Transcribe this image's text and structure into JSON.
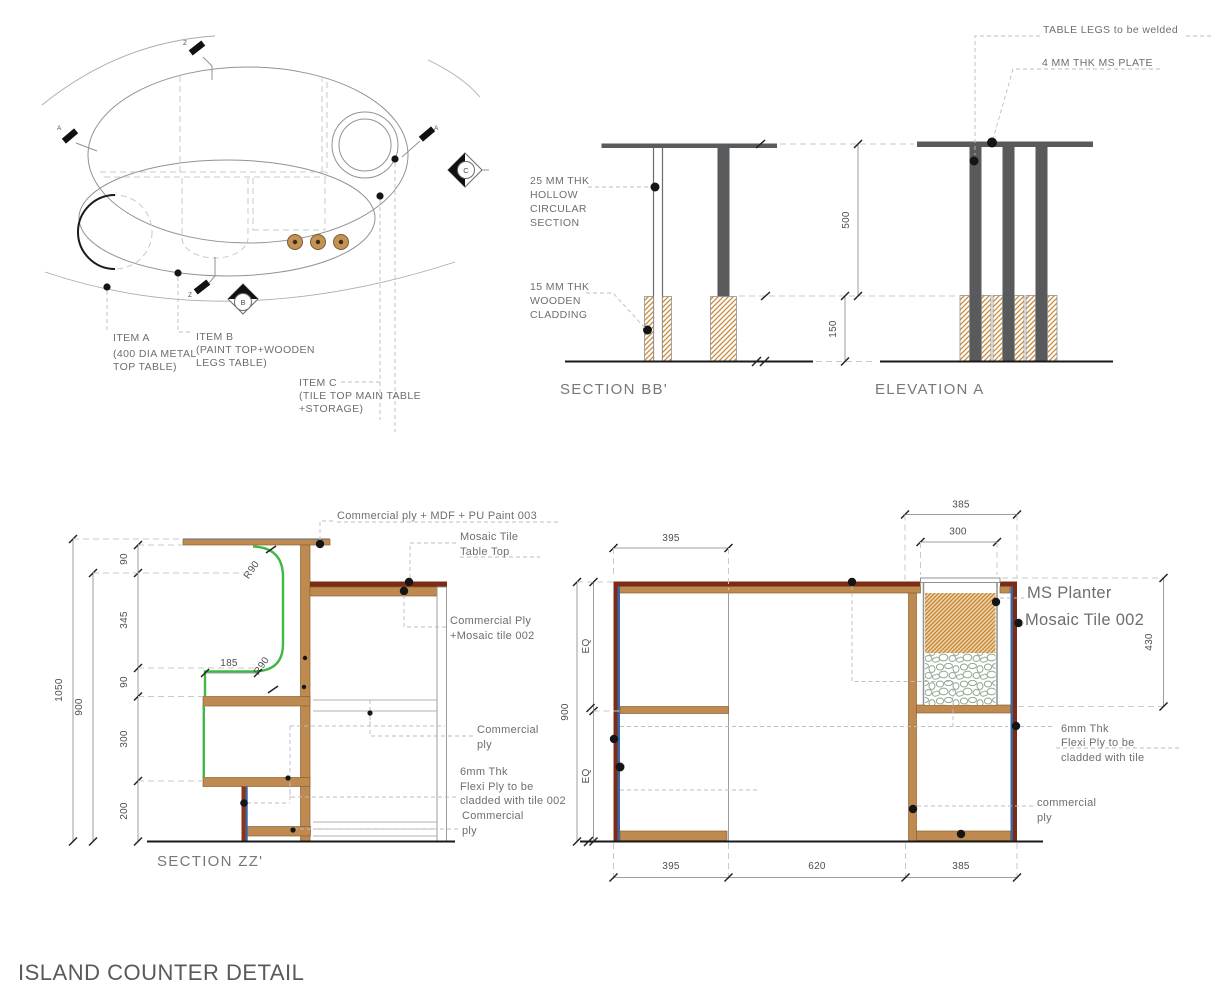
{
  "title": "ISLAND COUNTER DETAIL",
  "plan": {
    "items": {
      "a": [
        "ITEM A",
        "(400 DIA METAL",
        "TOP TABLE)"
      ],
      "b": [
        "ITEM B",
        "(PAINT TOP+WOODEN",
        "LEGS TABLE)"
      ],
      "c": [
        "ITEM C",
        "(TILE TOP MAIN TABLE",
        "+STORAGE)"
      ]
    },
    "markers": {
      "z": "Z",
      "a": "A",
      "b": "B",
      "c": "C"
    }
  },
  "section_bb": {
    "label": "SECTION BB'",
    "notes": {
      "hollow": [
        "25 MM THK",
        "HOLLOW",
        "CIRCULAR",
        "SECTION"
      ],
      "cladding": [
        "15 MM THK",
        "WOODEN",
        "CLADDING"
      ]
    },
    "dims": {
      "leg_height": "500",
      "cladding_height": "150"
    }
  },
  "elevation_a": {
    "label": "ELEVATION A",
    "notes": {
      "welded": "TABLE LEGS to be welded",
      "plate": "4 MM THK MS PLATE"
    }
  },
  "section_zz": {
    "label": "SECTION ZZ'",
    "dims": {
      "overall": "1050",
      "inner": "900",
      "segments": [
        "90",
        "345",
        "90",
        "300",
        "200"
      ],
      "depth": "185",
      "radius_top": "R90",
      "radius_bottom": "R90"
    },
    "notes": {
      "top": "Commercial ply + MDF + PU Paint 003",
      "mosaic": [
        "Mosaic Tile",
        "Table Top"
      ],
      "commercial_mosaic": [
        "Commercial Ply",
        "+Mosaic tile 002"
      ],
      "commercial_ply": [
        "Commercial",
        "ply"
      ],
      "flexi": [
        "6mm Thk",
        "Flexi Ply to be",
        "cladded with tile 002"
      ],
      "commercial_ply2": [
        "Commercial",
        "ply"
      ]
    }
  },
  "counter_elevation": {
    "dims": {
      "top_left": "395",
      "top_right": "385",
      "planter_width": "300",
      "planter_height": "430",
      "height": "900",
      "eq": "EQ",
      "bottom": [
        "395",
        "620",
        "385"
      ]
    },
    "notes": {
      "planter": "MS Planter",
      "tile": "Mosaic Tile 002",
      "flexi": [
        "6mm Thk",
        "Flexi Ply to be",
        "cladded with tile"
      ],
      "commercial": [
        "commercial",
        "ply"
      ]
    }
  },
  "colors": {
    "wood": "#BE8A50",
    "maroon": "#7E2B15",
    "blue": "#3465A8",
    "green": "#3FB844",
    "steel": "#595A5C",
    "hatch_orange": "#C8883A",
    "pebble_green": "#8FA891",
    "text_gray": "#6d6e71"
  }
}
